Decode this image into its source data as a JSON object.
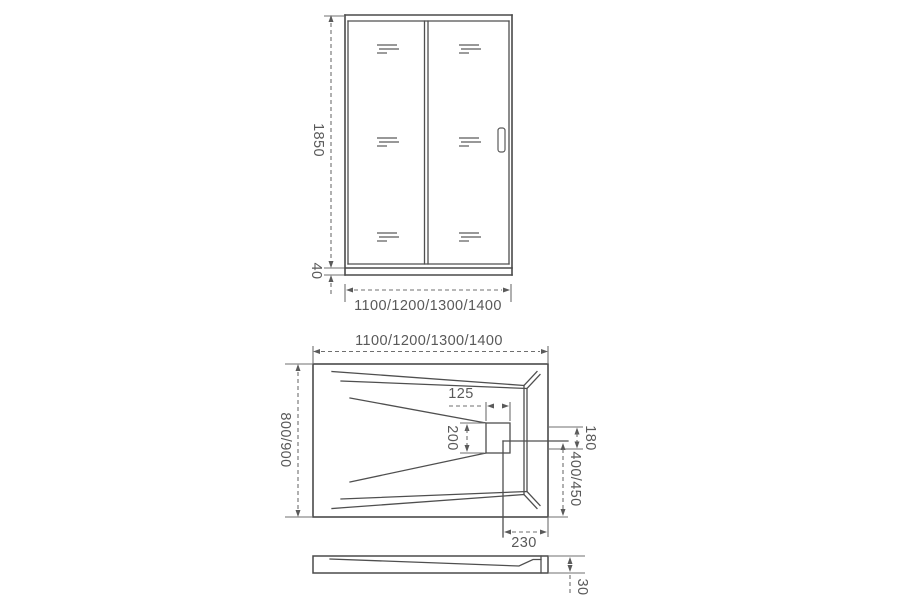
{
  "drawing": {
    "title": "shower-enclosure-technical-drawing",
    "front_view": {
      "height_label": "1850",
      "base_height_label": "40",
      "width_label": "1100/1200/1300/1400"
    },
    "top_view": {
      "width_label": "1100/1200/1300/1400",
      "depth_label": "800/900",
      "drain_width_label": "125",
      "drain_mouth_height_label": "200",
      "drain_side_height_label": "180",
      "drain_center_to_edge_label": "400/450",
      "drain_to_right_edge_label": "230"
    },
    "side_view": {
      "tray_thickness_label": "30"
    },
    "colors": {
      "line": "#4f4f4f",
      "dimension": "#6f6f6f",
      "text": "#595959",
      "background": "#ffffff"
    }
  }
}
